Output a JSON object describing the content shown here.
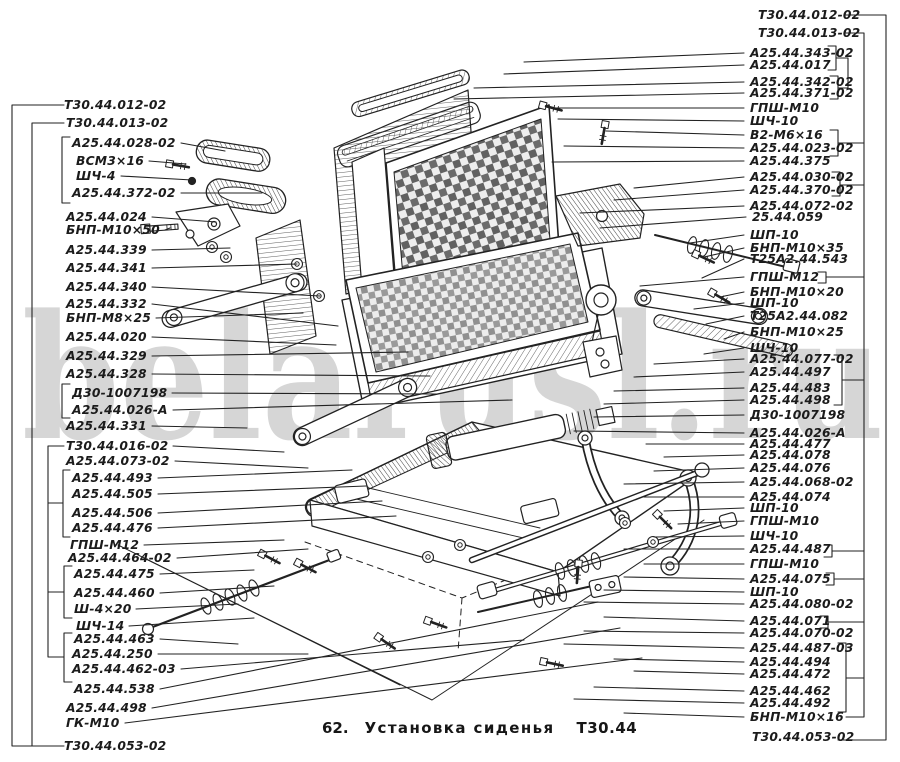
{
  "page": {
    "background": "#ffffff",
    "ink_color": "#1f1f1f",
    "watermark_color": "#c6c6c6"
  },
  "watermark": {
    "text": "belarusl.ru"
  },
  "figure_caption": {
    "number": "62.",
    "title": "Установка сиденья",
    "model_code": "Т30.44"
  },
  "part_labels": {
    "left": [
      "Т30.44.012-02",
      "Т30.44.013-02",
      "А25.44.028-02",
      "ВСМ3×16",
      "ШЧ-4",
      "А25.44.372-02",
      "А25.44.024",
      "БНП-М10×50",
      "А25.44.339",
      "А25.44.341",
      "А25.44.340",
      "А25.44.332",
      "БНП-М8×25",
      "А25.44.020",
      "А25.44.329",
      "А25.44.328",
      "Д30-1007198",
      "А25.44.026-А",
      "А25.44.331",
      "Т30.44.016-02",
      "А25.44.073-02",
      "А25.44.493",
      "А25.44.505",
      "А25.44.506",
      "А25.44.476",
      "ГПШ-М12",
      "А25.44.464-02",
      "А25.44.475",
      "А25.44.460",
      "Ш-4×20",
      "ШЧ-14",
      "А25.44.463",
      "А25.44.250",
      "А25.44.462-03",
      "А25.44.538",
      "А25.44.498",
      "ГК-М10",
      "Т30.44.053-02"
    ],
    "right": [
      "Т30.44.012-02",
      "Т30.44.013-02",
      "А25.44.343-02",
      "А25.44.017",
      "А25.44.342-02",
      "А25.44.371-02",
      "ГПШ-М10",
      "ШЧ-10",
      "В2-М6×16",
      "А25.44.023-02",
      "А25.44.375",
      "А25.44.030-02",
      "А25.44.370-02",
      "А25.44.072-02",
      "25.44.059",
      "ШП-10",
      "БНП-М10×35",
      "Т25А2.44.543",
      "ГПШ-М12",
      "БНП-М10×20",
      "ШП-10",
      "Т25А2.44.082",
      "БНП-М10×25",
      "ШЧ-10",
      "А25.44.077-02",
      "А25.44.497",
      "А25.44.483",
      "А25.44.498",
      "Д30-1007198",
      "А25.44.026-А",
      "А25.44.477",
      "А25.44.078",
      "А25.44.076",
      "А25.44.068-02",
      "А25.44.074",
      "ШП-10",
      "ГПШ-М10",
      "ШЧ-10",
      "А25.44.487",
      "ГПШ-М10",
      "А25.44.075",
      "ШП-10",
      "А25.44.080-02",
      "А25.44.071",
      "А25.44.070-02",
      "А25.44.487-03",
      "А25.44.494",
      "А25.44.472",
      "А25.44.462",
      "А25.44.492",
      "БНП-М10×16",
      "Т30.44.053-02"
    ]
  }
}
